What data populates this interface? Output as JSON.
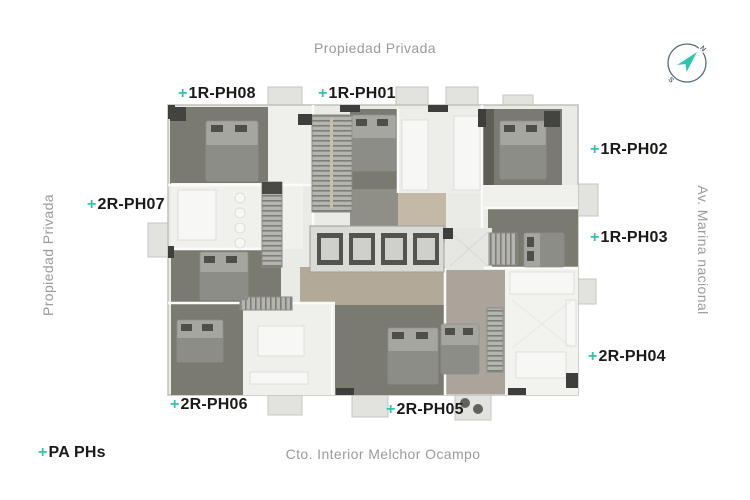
{
  "colors": {
    "accent": "#2ec5ad",
    "ink": "#1a1a18",
    "street": "#9c9c9c",
    "compass": "#5c6b76"
  },
  "streets": {
    "top": "Propiedad Privada",
    "left": "Propiedad Privada",
    "right": "Av. Marina nacional",
    "bottom": "Cto. Interior Melchor Ocampo"
  },
  "units": [
    {
      "plus": "+",
      "name": "1R-PH08"
    },
    {
      "plus": "+",
      "name": "1R-PH01"
    },
    {
      "plus": "+",
      "name": "1R-PH02"
    },
    {
      "plus": "+",
      "name": "1R-PH03"
    },
    {
      "plus": "+",
      "name": "2R-PH04"
    },
    {
      "plus": "+",
      "name": "2R-PH05"
    },
    {
      "plus": "+",
      "name": "2R-PH06"
    },
    {
      "plus": "+",
      "name": "2R-PH07"
    }
  ],
  "legend": {
    "plus": "+",
    "label": "PA PHs"
  },
  "compass": {
    "north": "N",
    "south": "S"
  }
}
